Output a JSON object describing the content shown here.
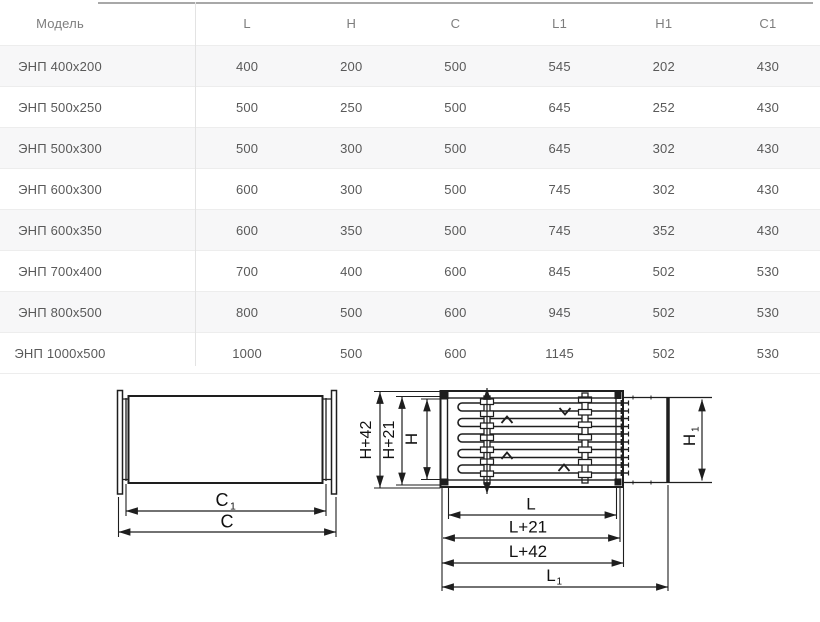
{
  "table": {
    "columns": [
      "Модель",
      "L",
      "H",
      "C",
      "L1",
      "H1",
      "C1"
    ],
    "rows": [
      {
        "model": "ЭНП 400x200",
        "values": [
          "400",
          "200",
          "500",
          "545",
          "202",
          "430"
        ]
      },
      {
        "model": "ЭНП 500x250",
        "values": [
          "500",
          "250",
          "500",
          "645",
          "252",
          "430"
        ]
      },
      {
        "model": "ЭНП 500x300",
        "values": [
          "500",
          "300",
          "500",
          "645",
          "302",
          "430"
        ]
      },
      {
        "model": "ЭНП 600x300",
        "values": [
          "600",
          "300",
          "500",
          "745",
          "302",
          "430"
        ]
      },
      {
        "model": "ЭНП 600x350",
        "values": [
          "600",
          "350",
          "500",
          "745",
          "352",
          "430"
        ]
      },
      {
        "model": "ЭНП 700x400",
        "values": [
          "700",
          "400",
          "600",
          "845",
          "502",
          "530"
        ]
      },
      {
        "model": "ЭНП 800x500",
        "values": [
          "800",
          "500",
          "600",
          "945",
          "502",
          "530"
        ]
      },
      {
        "model": "ЭНП 1000x500",
        "values": [
          "1000",
          "500",
          "600",
          "1145",
          "502",
          "530"
        ]
      }
    ]
  },
  "diagram_left": {
    "dim_c1_base": "C",
    "dim_c1_sub": "1",
    "dim_c": "C"
  },
  "diagram_right": {
    "dim_h42": "H+42",
    "dim_h21": "H+21",
    "dim_h": "H",
    "dim_h1_base": "H",
    "dim_h1_sub": "1",
    "dim_l": "L",
    "dim_l21": "L+21",
    "dim_l42": "L+42",
    "dim_l1_base": "L",
    "dim_l1_sub": "1"
  },
  "colors": {
    "row_stripe": "#f7f7f8",
    "row_border": "#ededed",
    "column_divider": "#e3e3e3",
    "table_top_border": "#a8a8a8",
    "header_text": "#7d7d7d",
    "cell_text": "#595959",
    "drawing_ink": "#1e1e1e"
  }
}
